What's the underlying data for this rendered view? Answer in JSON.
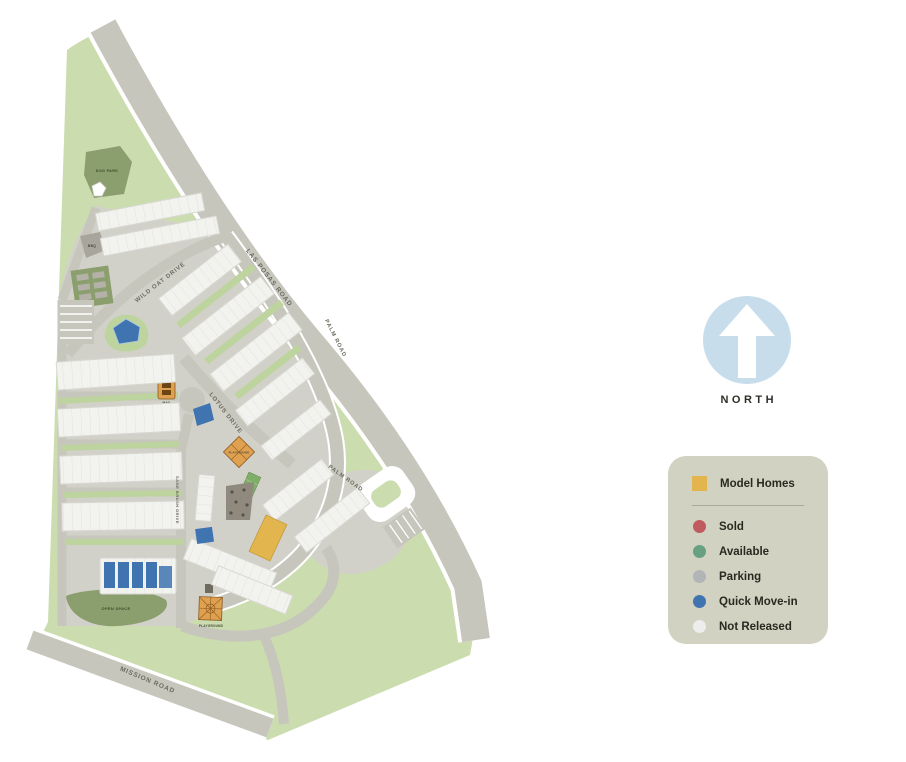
{
  "map": {
    "roads": {
      "las_posas": "LAS POSAS ROAD",
      "wild_oat": "WILD OAT DRIVE",
      "lotus": "LOTUS DRIVE",
      "palm": "PALM ROAD",
      "mission": "MISSION ROAD",
      "sage": "SAGE BRUSH DRIVE"
    },
    "features": {
      "dog_park": "DOG PARK",
      "bbq": "BBQ",
      "garden": "GARDEN",
      "playground": "PLAYGROUND",
      "open_space": "OPEN SPACE",
      "mail": "MAIL"
    }
  },
  "north": {
    "label": "NORTH"
  },
  "legend": {
    "model_homes": {
      "label": "Model Homes"
    },
    "items": [
      {
        "label": "Sold",
        "key": "sold"
      },
      {
        "label": "Available",
        "key": "available"
      },
      {
        "label": "Parking",
        "key": "parking"
      },
      {
        "label": "Quick Move-in",
        "key": "quick-move-in"
      },
      {
        "label": "Not Released",
        "key": "not-released"
      }
    ]
  },
  "colors": {
    "model": "#e3b54e",
    "sold": "#bf5a5e",
    "available": "#68a181",
    "parking": "#b2b5b7",
    "quick-move-in": "#3f74b0",
    "not-released": "#ecedec",
    "site-green": "#cbdcae",
    "landscape-dark": "#8b9e6d",
    "pavement": "#d2d1c9",
    "road": "#c7c6bd",
    "legend-bg": "#d1d2c2",
    "north-blue": "#c7ddec"
  }
}
